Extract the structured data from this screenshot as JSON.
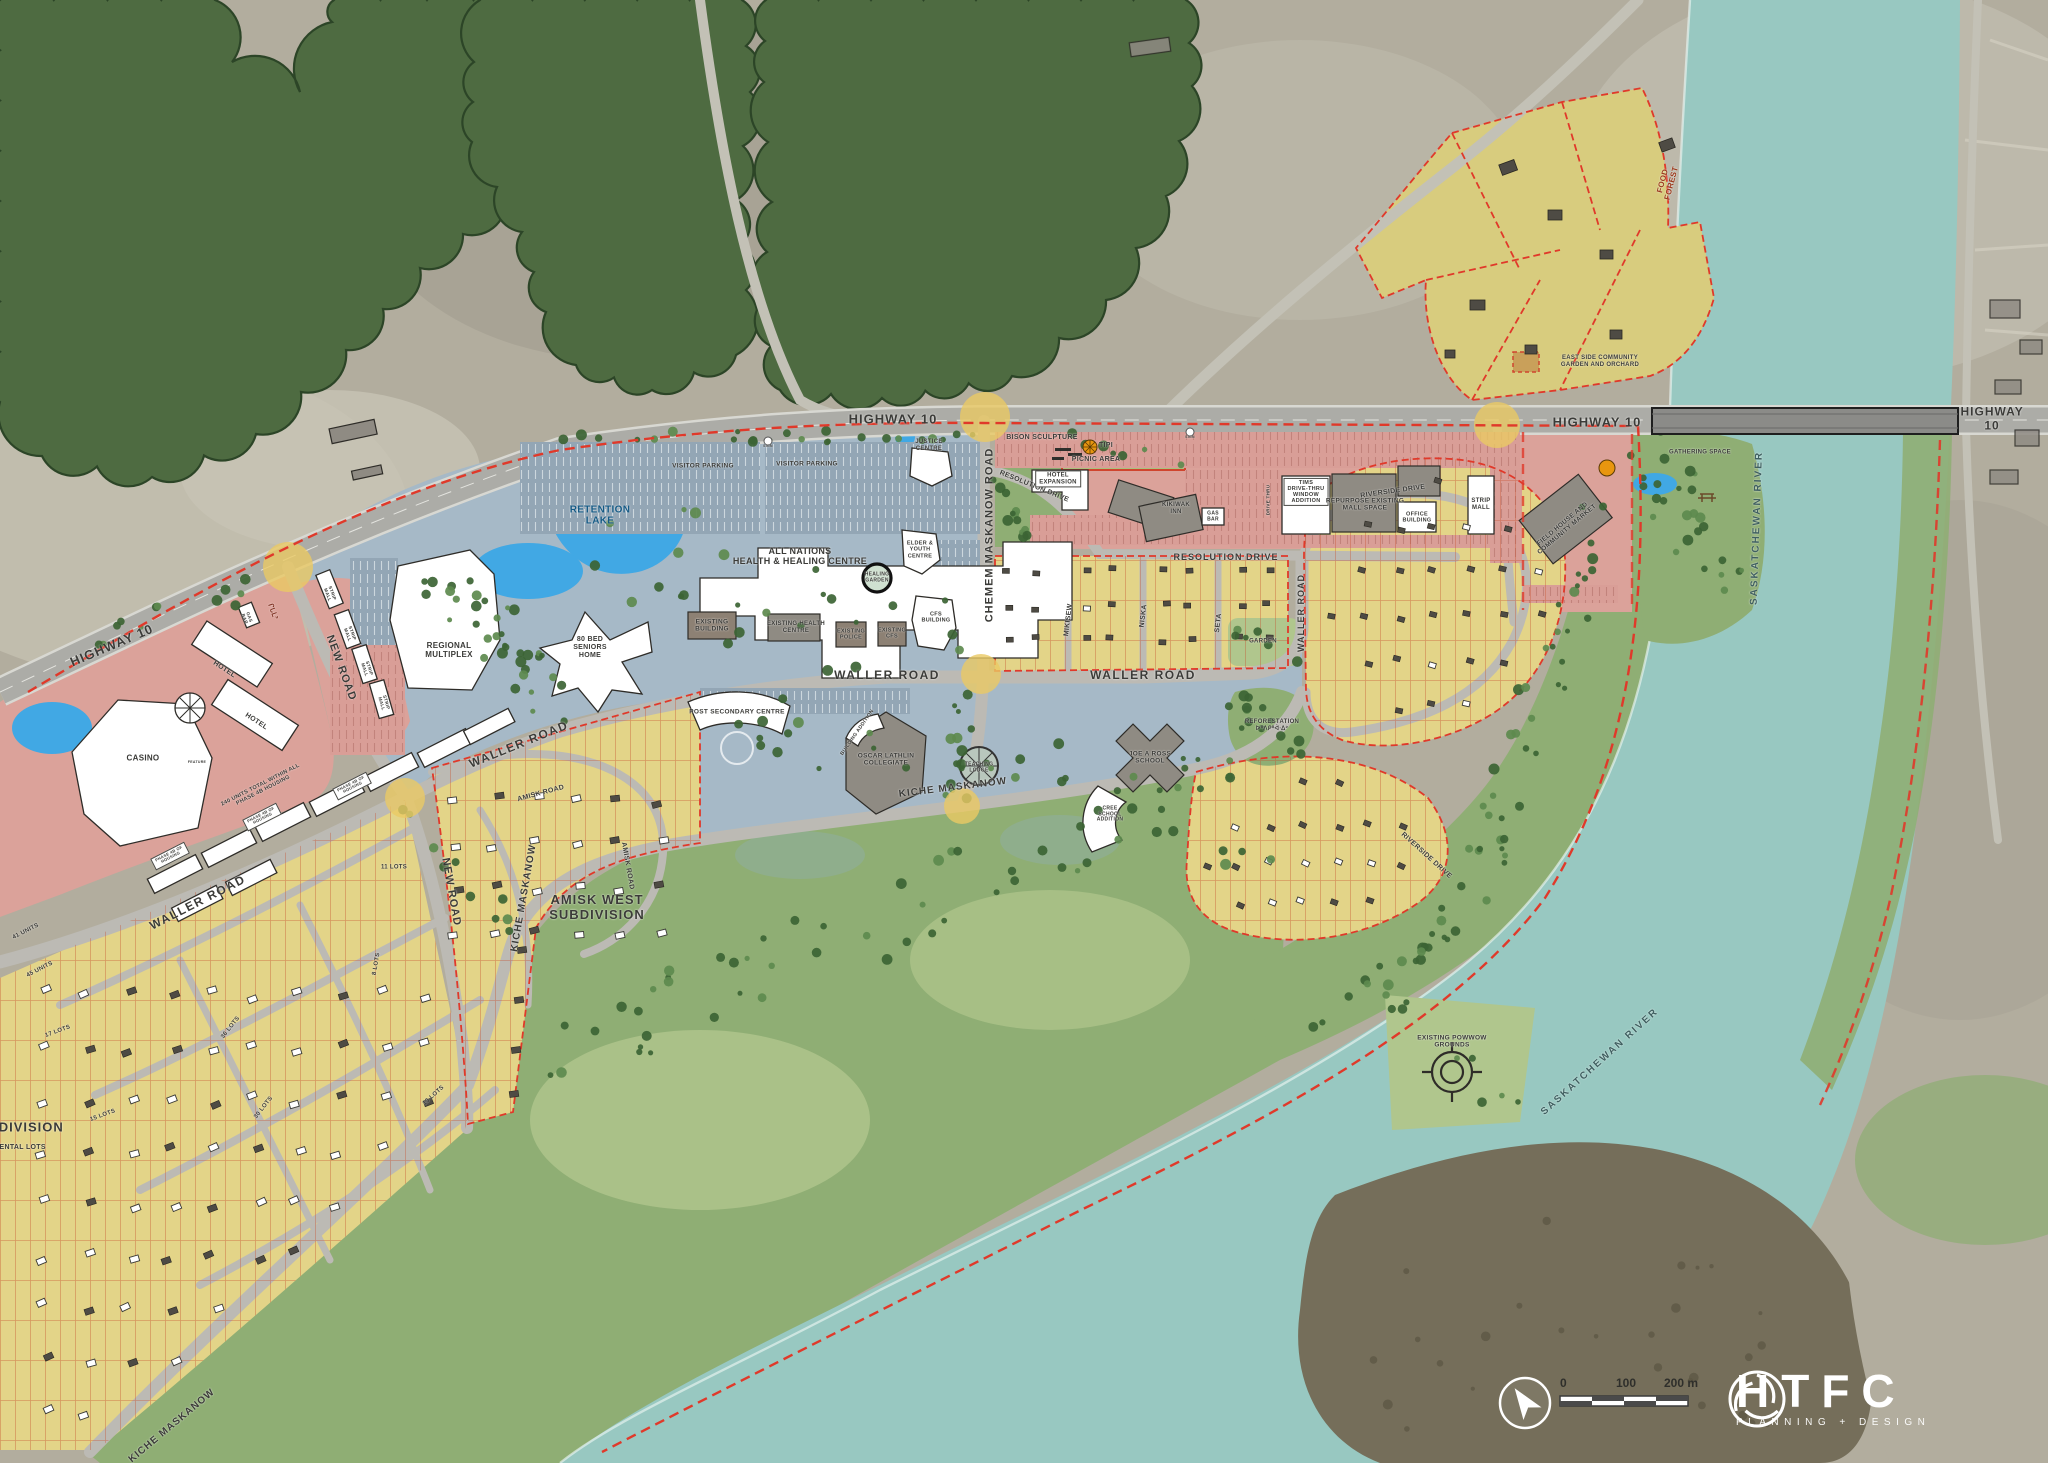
{
  "colors": {
    "forest": "#4e6b41",
    "forest-edge": "#2c4527",
    "river": "#98c8c1",
    "island": "#756e5a",
    "aerial": "#b2ad9e",
    "road": "#bcbab4",
    "hwy": "#acaca7",
    "commercial": "#dba29a",
    "institutional": "#a6b9c7",
    "parking-blue": "#93a6b5",
    "parking-pink": "#d99e97",
    "residential": "#e3d488",
    "residential-dark": "#d8cc7e",
    "park": "#8fae74",
    "park-light": "#b0c68d",
    "lot-line": "#c6502f",
    "boundary": "#e0392a",
    "highlight": "#eac964",
    "water": "#41a8e4"
  },
  "labels": [
    {
      "t": "HIGHWAY 10",
      "x": 112,
      "y": 646,
      "r": -23,
      "s": 13,
      "ls": 1
    },
    {
      "t": "HIGHWAY 10",
      "x": 893,
      "y": 420,
      "s": 13,
      "ls": 1
    },
    {
      "t": "HIGHWAY 10",
      "x": 1597,
      "y": 423,
      "s": 13,
      "ls": 1
    },
    {
      "t": "HIGHWAY 10",
      "x": 1992,
      "y": 419,
      "s": 12,
      "ls": 1
    },
    {
      "t": "NEW ROAD",
      "x": 341,
      "y": 668,
      "r": 70,
      "s": 11,
      "ls": 1
    },
    {
      "t": "NEW ROAD",
      "x": 451,
      "y": 892,
      "r": 80,
      "s": 11,
      "ls": 1
    },
    {
      "t": "WALLER ROAD",
      "x": 887,
      "y": 676,
      "s": 12,
      "ls": 1.5
    },
    {
      "t": "WALLER ROAD",
      "x": 1143,
      "y": 676,
      "s": 12,
      "ls": 1.5
    },
    {
      "t": "WALLER ROAD",
      "x": 519,
      "y": 745,
      "r": -22,
      "s": 12,
      "ls": 1.5
    },
    {
      "t": "WALLER ROAD",
      "x": 198,
      "y": 903,
      "r": -27,
      "s": 12,
      "ls": 1.5
    },
    {
      "t": "WALLER ROAD",
      "x": 1301,
      "y": 613,
      "r": -90,
      "s": 9,
      "ls": 1
    },
    {
      "t": "CHEMEM MASKANOW ROAD",
      "x": 990,
      "y": 535,
      "r": -90,
      "s": 11,
      "ls": 1
    },
    {
      "t": "RESOLUTION DRIVE",
      "x": 1226,
      "y": 557,
      "s": 9,
      "ls": 1
    },
    {
      "t": "RESOLUTION DRIVE",
      "x": 1034,
      "y": 487,
      "r": 22,
      "s": 7
    },
    {
      "t": "KICHE MASKANOW",
      "x": 953,
      "y": 788,
      "r": -7,
      "s": 10,
      "ls": 1
    },
    {
      "t": "KICHE MASKANOW",
      "x": 524,
      "y": 898,
      "r": -80,
      "s": 10,
      "ls": 1
    },
    {
      "t": "KICHE MASKANOW",
      "x": 172,
      "y": 1426,
      "r": -40,
      "s": 10,
      "ls": 1
    },
    {
      "t": "AMISK ROAD",
      "x": 541,
      "y": 794,
      "r": -15,
      "s": 7
    },
    {
      "t": "AMISK ROAD",
      "x": 627,
      "y": 866,
      "r": 80,
      "s": 7
    },
    {
      "t": "MIKISEW",
      "x": 1069,
      "y": 620,
      "r": -83,
      "s": 7
    },
    {
      "t": "NISKA",
      "x": 1144,
      "y": 616,
      "r": -83,
      "s": 7
    },
    {
      "t": "SETA",
      "x": 1219,
      "y": 623,
      "r": -83,
      "s": 7
    },
    {
      "t": "RIVERSIDE DRIVE",
      "x": 1393,
      "y": 492,
      "r": -8,
      "s": 7
    },
    {
      "t": "RIVERSIDE DRIVE",
      "x": 1426,
      "y": 856,
      "r": 42,
      "s": 7
    },
    {
      "t": "SASKATCHEWAN RIVER",
      "x": 1757,
      "y": 528,
      "r": -88,
      "s": 10,
      "ls": 2,
      "c": "#3f5f60"
    },
    {
      "t": "SASKATCHEWAN RIVER",
      "x": 1600,
      "y": 1062,
      "r": -42,
      "s": 10,
      "ls": 2,
      "c": "#3f5f60"
    },
    {
      "t": "RETENTION\nLAKE",
      "x": 600,
      "y": 516,
      "s": 10,
      "c": "#155a85"
    },
    {
      "t": "CASINO",
      "x": 143,
      "y": 758,
      "s": 8
    },
    {
      "t": "HOTEL",
      "x": 224,
      "y": 670,
      "r": 33,
      "s": 7
    },
    {
      "t": "HOTEL",
      "x": 256,
      "y": 722,
      "r": 33,
      "s": 7
    },
    {
      "t": "FEATURE",
      "x": 197,
      "y": 762,
      "s": 3.5
    },
    {
      "t": "GAS\nBAR",
      "x": 247,
      "y": 618,
      "r": 70,
      "s": 4.5
    },
    {
      "t": "ᒋᒐᒪᐣ",
      "x": 272,
      "y": 612,
      "r": 70,
      "s": 7,
      "c": "#7d2e1e"
    },
    {
      "t": "STRIP\nMALL",
      "x": 330,
      "y": 594,
      "r": 70,
      "s": 4.5
    },
    {
      "t": "STRIP\nMALL",
      "x": 350,
      "y": 634,
      "r": 70,
      "s": 4.5
    },
    {
      "t": "STRIP\nMALL",
      "x": 367,
      "y": 669,
      "r": 72,
      "s": 4.5
    },
    {
      "t": "STRIP\nMALL",
      "x": 384,
      "y": 703,
      "r": 74,
      "s": 4.5
    },
    {
      "t": "REGIONAL\nMULTIPLEX",
      "x": 449,
      "y": 650,
      "s": 8
    },
    {
      "t": "80 BED\nSENIORS\nHOME",
      "x": 590,
      "y": 648,
      "s": 7
    },
    {
      "t": "VISITOR PARKING",
      "x": 703,
      "y": 466,
      "s": 6.5
    },
    {
      "t": "VISITOR PARKING",
      "x": 807,
      "y": 464,
      "s": 6.5
    },
    {
      "t": "SIGN",
      "x": 768,
      "y": 446,
      "s": 3.5
    },
    {
      "t": "SIGN",
      "x": 1190,
      "y": 437,
      "s": 3.5
    },
    {
      "t": "JUSTICE\nCENTRE",
      "x": 929,
      "y": 446,
      "s": 6
    },
    {
      "t": "ALL NATIONS\nHEALTH & HEALING CENTRE",
      "x": 800,
      "y": 556,
      "s": 9
    },
    {
      "t": "HEALING\nGARDEN",
      "x": 877,
      "y": 578,
      "s": 5
    },
    {
      "t": "ELDER &\nYOUTH\nCENTRE",
      "x": 920,
      "y": 550,
      "s": 5.5
    },
    {
      "t": "CFS\nBUILDING",
      "x": 936,
      "y": 618,
      "s": 5.5
    },
    {
      "t": "EXISTING\nBUILDING",
      "x": 712,
      "y": 626,
      "s": 6.5
    },
    {
      "t": "EXISTING HEALTH\nCENTRE",
      "x": 796,
      "y": 628,
      "s": 6
    },
    {
      "t": "EXISTING\nPOLICE",
      "x": 851,
      "y": 635,
      "s": 5.5
    },
    {
      "t": "EXISTING\nCFS",
      "x": 892,
      "y": 634,
      "s": 5.5
    },
    {
      "t": "BISON SCULPTURE",
      "x": 1042,
      "y": 438,
      "s": 7
    },
    {
      "t": "TIPI",
      "x": 1106,
      "y": 446,
      "s": 7
    },
    {
      "t": "PICNIC AREA",
      "x": 1096,
      "y": 460,
      "s": 7
    },
    {
      "t": "HOTEL\nEXPANSION",
      "x": 1058,
      "y": 479,
      "s": 6,
      "box": true
    },
    {
      "t": "KIKIWAK\nINN",
      "x": 1176,
      "y": 509,
      "s": 6
    },
    {
      "t": "TIMS\nDRIVE-THRU\nWINDOW\nADDITION",
      "x": 1306,
      "y": 492,
      "s": 5.5,
      "box": true
    },
    {
      "t": "DRIVE THRU",
      "x": 1268,
      "y": 500,
      "r": -90,
      "s": 4.5
    },
    {
      "t": "REPURPOSE EXISTING\nMALL SPACE",
      "x": 1365,
      "y": 505,
      "s": 6.5
    },
    {
      "t": "OFFICE\nBUILDING",
      "x": 1417,
      "y": 518,
      "s": 5.5
    },
    {
      "t": "STRIP\nMALL",
      "x": 1481,
      "y": 505,
      "s": 6
    },
    {
      "t": "GAS\nBAR",
      "x": 1213,
      "y": 517,
      "s": 5
    },
    {
      "t": "FIELD HOUSE AND\nCOMMUNITY MARKET",
      "x": 1565,
      "y": 527,
      "r": -40,
      "s": 6.5
    },
    {
      "t": "GATHERING SPACE",
      "x": 1700,
      "y": 453,
      "s": 6
    },
    {
      "t": "FOOD\nFOREST",
      "x": 1667,
      "y": 182,
      "r": -75,
      "s": 8,
      "c": "#9c3a1d"
    },
    {
      "t": "EAST SIDE COMMUNITY\nGARDEN AND ORCHARD",
      "x": 1600,
      "y": 362,
      "s": 6
    },
    {
      "t": "POST SECONDARY CENTRE",
      "x": 737,
      "y": 712,
      "s": 6.5
    },
    {
      "t": "OSCAR LATHLIN\nCOLLEGIATE",
      "x": 886,
      "y": 760,
      "s": 6.5
    },
    {
      "t": "BUILDING ADDITION",
      "x": 858,
      "y": 733,
      "r": -55,
      "s": 5
    },
    {
      "t": "TEACHING\nLODGE",
      "x": 979,
      "y": 768,
      "s": 5
    },
    {
      "t": "JOE A ROSS\nSCHOOL",
      "x": 1150,
      "y": 758,
      "s": 6.5
    },
    {
      "t": "CREE\nSCHOOL\nADDITION",
      "x": 1110,
      "y": 815,
      "s": 5
    },
    {
      "t": "REFORESTATION\nᐅᐦᐱᑭᐦᐋᐧᐃᐣ",
      "x": 1272,
      "y": 726,
      "s": 6
    },
    {
      "t": "GARDEN",
      "x": 1263,
      "y": 642,
      "s": 6
    },
    {
      "t": "AMISK WEST\nSUBDIVISION",
      "x": 597,
      "y": 908,
      "s": 13,
      "ls": 1
    },
    {
      "t": "SUBDIVISION",
      "x": 16,
      "y": 1128,
      "s": 13,
      "ls": 1
    },
    {
      "t": "RENTAL LOTS",
      "x": 20,
      "y": 1148,
      "s": 7
    },
    {
      "t": "11 LOTS",
      "x": 394,
      "y": 868,
      "s": 6
    },
    {
      "t": "8 LOTS",
      "x": 377,
      "y": 964,
      "r": -80,
      "s": 6
    },
    {
      "t": "17 LOTS",
      "x": 58,
      "y": 1032,
      "r": -20,
      "s": 6
    },
    {
      "t": "15 LOTS",
      "x": 103,
      "y": 1116,
      "r": -20,
      "s": 6
    },
    {
      "t": "36 LOTS",
      "x": 231,
      "y": 1028,
      "r": -52,
      "s": 6
    },
    {
      "t": "30 LOTS",
      "x": 264,
      "y": 1108,
      "r": -52,
      "s": 6
    },
    {
      "t": "13 LOTS",
      "x": 434,
      "y": 1096,
      "r": -42,
      "s": 6
    },
    {
      "t": "240 UNITS TOTAL WITHIN ALL\nPHASE 4B HOUSING",
      "x": 262,
      "y": 788,
      "r": -27,
      "s": 5.5
    },
    {
      "t": "PHASE 4B OF\nHOUSING",
      "x": 170,
      "y": 856,
      "r": -27,
      "s": 4,
      "box": true
    },
    {
      "t": "PHASE 4B OF\nHOUSING",
      "x": 262,
      "y": 817,
      "r": -27,
      "s": 4,
      "box": true
    },
    {
      "t": "PHASE 4B OF\nHOUSING",
      "x": 352,
      "y": 786,
      "r": -27,
      "s": 4,
      "box": true
    },
    {
      "t": "41 UNITS",
      "x": 26,
      "y": 932,
      "r": -27,
      "s": 6
    },
    {
      "t": "45 UNITS",
      "x": 40,
      "y": 970,
      "r": -27,
      "s": 6
    },
    {
      "t": "EXISTING POWWOW\nGROUNDS",
      "x": 1452,
      "y": 1042,
      "s": 6.5
    }
  ],
  "legend": {
    "scale_ticks": [
      "0",
      "100",
      "200 m"
    ],
    "logo": "HTFC",
    "logo_sub": "PLANNING + DESIGN"
  }
}
